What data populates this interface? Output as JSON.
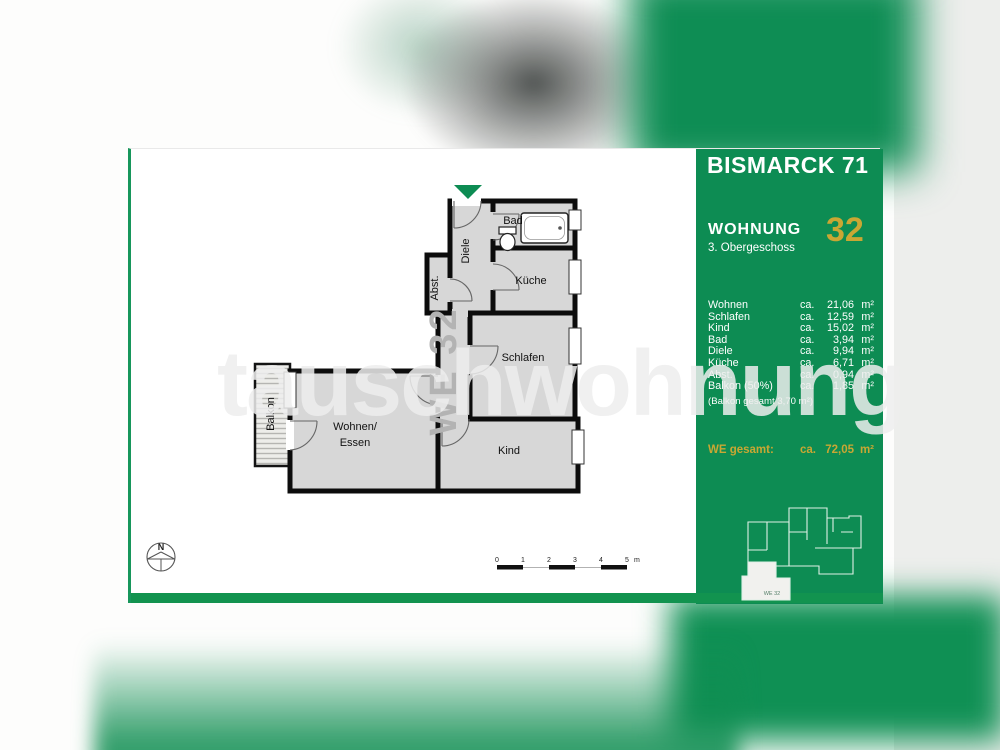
{
  "watermark": "tauschwohnung",
  "card": {
    "header": {
      "title": "BISMARCK 71"
    },
    "unit": {
      "label": "WOHNUNG",
      "floor": "3. Obergeschoss",
      "number": "32"
    },
    "rooms": [
      {
        "label": "Wohnen",
        "ca": "ca.",
        "num": "21,06",
        "unit": "m²"
      },
      {
        "label": "Schlafen",
        "ca": "ca.",
        "num": "12,59",
        "unit": "m²"
      },
      {
        "label": "Kind",
        "ca": "ca.",
        "num": "15,02",
        "unit": "m²"
      },
      {
        "label": "Bad",
        "ca": "ca.",
        "num": "3,94",
        "unit": "m²"
      },
      {
        "label": "Diele",
        "ca": "ca.",
        "num": "9,94",
        "unit": "m²"
      },
      {
        "label": "Küche",
        "ca": "ca.",
        "num": "6,71",
        "unit": "m²"
      },
      {
        "label": "Abst.",
        "ca": "ca.",
        "num": "0,94",
        "unit": "m²"
      },
      {
        "label": "Balkon (50%)",
        "ca": "ca.",
        "num": "1,85",
        "unit": "m²"
      }
    ],
    "balkon_note": "(Balkon gesamt 3,70 m²)",
    "total": {
      "label": "WE gesamt:",
      "ca": "ca.",
      "num": "72,05",
      "unit": "m²"
    },
    "building": {
      "unit_label": "WE 32"
    }
  },
  "floorplan": {
    "rooms": {
      "bad": "Bad",
      "kueche": "Küche",
      "schlafen": "Schlafen",
      "kind": "Kind",
      "wohnen_line1": "Wohnen/",
      "wohnen_line2": "Essen",
      "diele": "Diele",
      "abst": "Abst.",
      "balkon": "Balkon"
    },
    "we_label": "WE 32"
  },
  "compass": {
    "label": "N"
  },
  "scalebar": {
    "labels": [
      "0",
      "1",
      "2",
      "3",
      "4",
      "5"
    ],
    "unit": "m"
  },
  "colors": {
    "green": "#0D8C53",
    "bar_green": "#12934F",
    "yellow": "#C9A733"
  }
}
